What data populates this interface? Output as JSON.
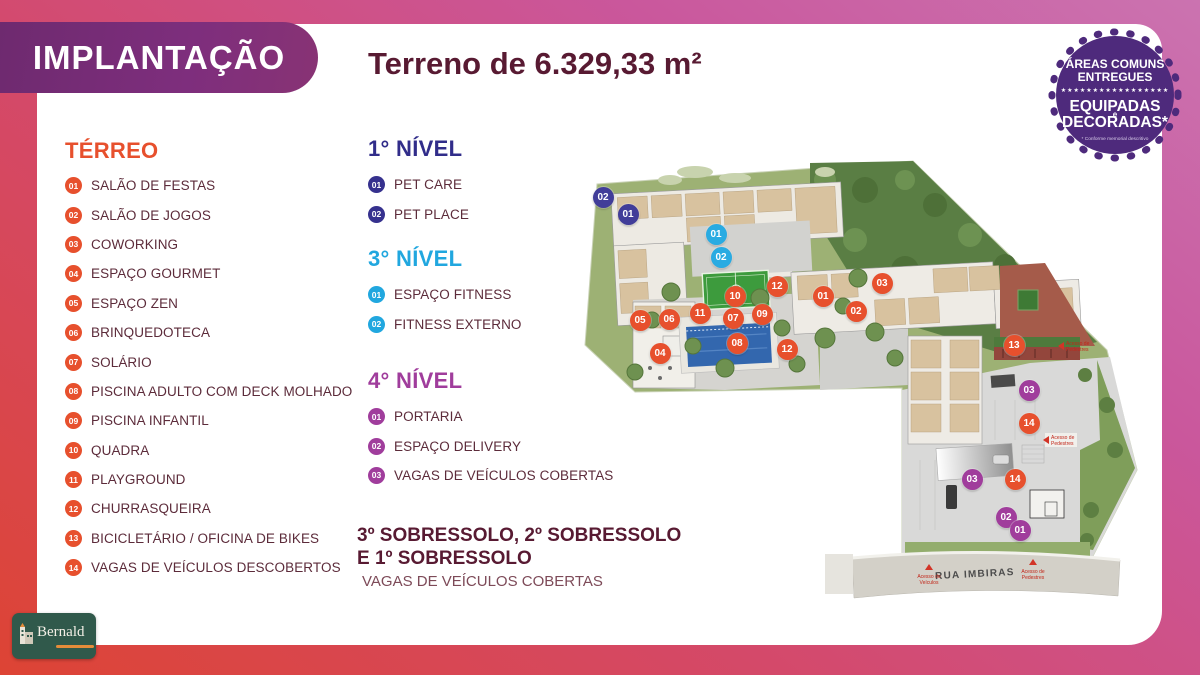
{
  "header": {
    "badge_label": "IMPLANTAÇÃO",
    "title": "Terreno de 6.329,33 m²"
  },
  "seal": {
    "line1": "ÁREAS COMUNS",
    "line2": "ENTREGUES",
    "stars": "★★★★★★★★★★★★★★★★★",
    "line3": "EQUIPADAS",
    "line3_mid": "e",
    "line4": "DECORADAS*",
    "footnote": "* Conforme memorial descritivo",
    "color": "#4e2a7c"
  },
  "legend": {
    "terreo": {
      "title": "TÉRREO",
      "color": "#e7502d",
      "items": [
        {
          "num": "01",
          "label": "SALÃO DE FESTAS"
        },
        {
          "num": "02",
          "label": "SALÃO DE JOGOS"
        },
        {
          "num": "03",
          "label": "COWORKING"
        },
        {
          "num": "04",
          "label": "ESPAÇO GOURMET"
        },
        {
          "num": "05",
          "label": "ESPAÇO ZEN"
        },
        {
          "num": "06",
          "label": "BRINQUEDOTECA"
        },
        {
          "num": "07",
          "label": "SOLÁRIO"
        },
        {
          "num": "08",
          "label": "PISCINA ADULTO COM DECK MOLHADO"
        },
        {
          "num": "09",
          "label": "PISCINA INFANTIL"
        },
        {
          "num": "10",
          "label": "QUADRA"
        },
        {
          "num": "11",
          "label": "PLAYGROUND"
        },
        {
          "num": "12",
          "label": "CHURRASQUEIRA"
        },
        {
          "num": "13",
          "label": "BICICLETÁRIO / OFICINA DE BIKES"
        },
        {
          "num": "14",
          "label": "VAGAS DE VEÍCULOS DESCOBERTOS"
        }
      ]
    },
    "nivel1": {
      "title": "1° NÍVEL",
      "color": "#312d8a",
      "items": [
        {
          "num": "01",
          "label": "PET CARE"
        },
        {
          "num": "02",
          "label": "PET PLACE"
        }
      ]
    },
    "nivel3": {
      "title": "3° NÍVEL",
      "color": "#21a7df",
      "items": [
        {
          "num": "01",
          "label": "ESPAÇO FITNESS"
        },
        {
          "num": "02",
          "label": "FITNESS EXTERNO"
        }
      ]
    },
    "nivel4": {
      "title": "4° NÍVEL",
      "color": "#a03d9c",
      "items": [
        {
          "num": "01",
          "label": "PORTARIA"
        },
        {
          "num": "02",
          "label": "ESPAÇO DELIVERY"
        },
        {
          "num": "03",
          "label": "VAGAS DE VEÍCULOS COBERTAS"
        }
      ]
    },
    "sobressolo": {
      "title_line1": "3º SOBRESSOLO, 2º SOBRESSOLO",
      "title_line2": "E 1º SOBRESSOLO",
      "note": "VAGAS DE VEÍCULOS COBERTAS"
    }
  },
  "plan": {
    "street_name": "RUA IMBIRAS",
    "access_labels": {
      "vehicles_line1": "Acesso de",
      "vehicles_line2": "Veículos",
      "pedestrians_line1": "Acesso de",
      "pedestrians_line2": "Pedestres"
    },
    "marker_colors": {
      "terreo": "#e7502d",
      "nivel1": "#413d99",
      "nivel3": "#29abe2",
      "nivel4": "#a03d9c"
    },
    "markers": [
      {
        "n": "02",
        "t": "nivel1",
        "x": 603,
        "y": 197
      },
      {
        "n": "01",
        "t": "nivel1",
        "x": 628,
        "y": 214
      },
      {
        "n": "01",
        "t": "nivel3",
        "x": 716,
        "y": 234
      },
      {
        "n": "02",
        "t": "nivel3",
        "x": 721,
        "y": 257
      },
      {
        "n": "12",
        "t": "terreo",
        "x": 777,
        "y": 286
      },
      {
        "n": "10",
        "t": "terreo",
        "x": 735,
        "y": 296
      },
      {
        "n": "03",
        "t": "terreo",
        "x": 882,
        "y": 283
      },
      {
        "n": "01",
        "t": "terreo",
        "x": 823,
        "y": 296
      },
      {
        "n": "02",
        "t": "terreo",
        "x": 856,
        "y": 311
      },
      {
        "n": "11",
        "t": "terreo",
        "x": 700,
        "y": 313
      },
      {
        "n": "09",
        "t": "terreo",
        "x": 762,
        "y": 314
      },
      {
        "n": "07",
        "t": "terreo",
        "x": 733,
        "y": 318
      },
      {
        "n": "05",
        "t": "terreo",
        "x": 640,
        "y": 320
      },
      {
        "n": "06",
        "t": "terreo",
        "x": 669,
        "y": 319
      },
      {
        "n": "08",
        "t": "terreo",
        "x": 737,
        "y": 343
      },
      {
        "n": "04",
        "t": "terreo",
        "x": 660,
        "y": 353
      },
      {
        "n": "12",
        "t": "terreo",
        "x": 787,
        "y": 349
      },
      {
        "n": "13",
        "t": "terreo",
        "x": 1014,
        "y": 345
      },
      {
        "n": "03",
        "t": "nivel4",
        "x": 1029,
        "y": 390
      },
      {
        "n": "14",
        "t": "terreo",
        "x": 1029,
        "y": 423
      },
      {
        "n": "03",
        "t": "nivel4",
        "x": 972,
        "y": 479
      },
      {
        "n": "14",
        "t": "terreo",
        "x": 1015,
        "y": 479
      },
      {
        "n": "02",
        "t": "nivel4",
        "x": 1006,
        "y": 517
      },
      {
        "n": "01",
        "t": "nivel4",
        "x": 1020,
        "y": 530
      }
    ]
  },
  "logo": {
    "brand": "Bernald"
  }
}
